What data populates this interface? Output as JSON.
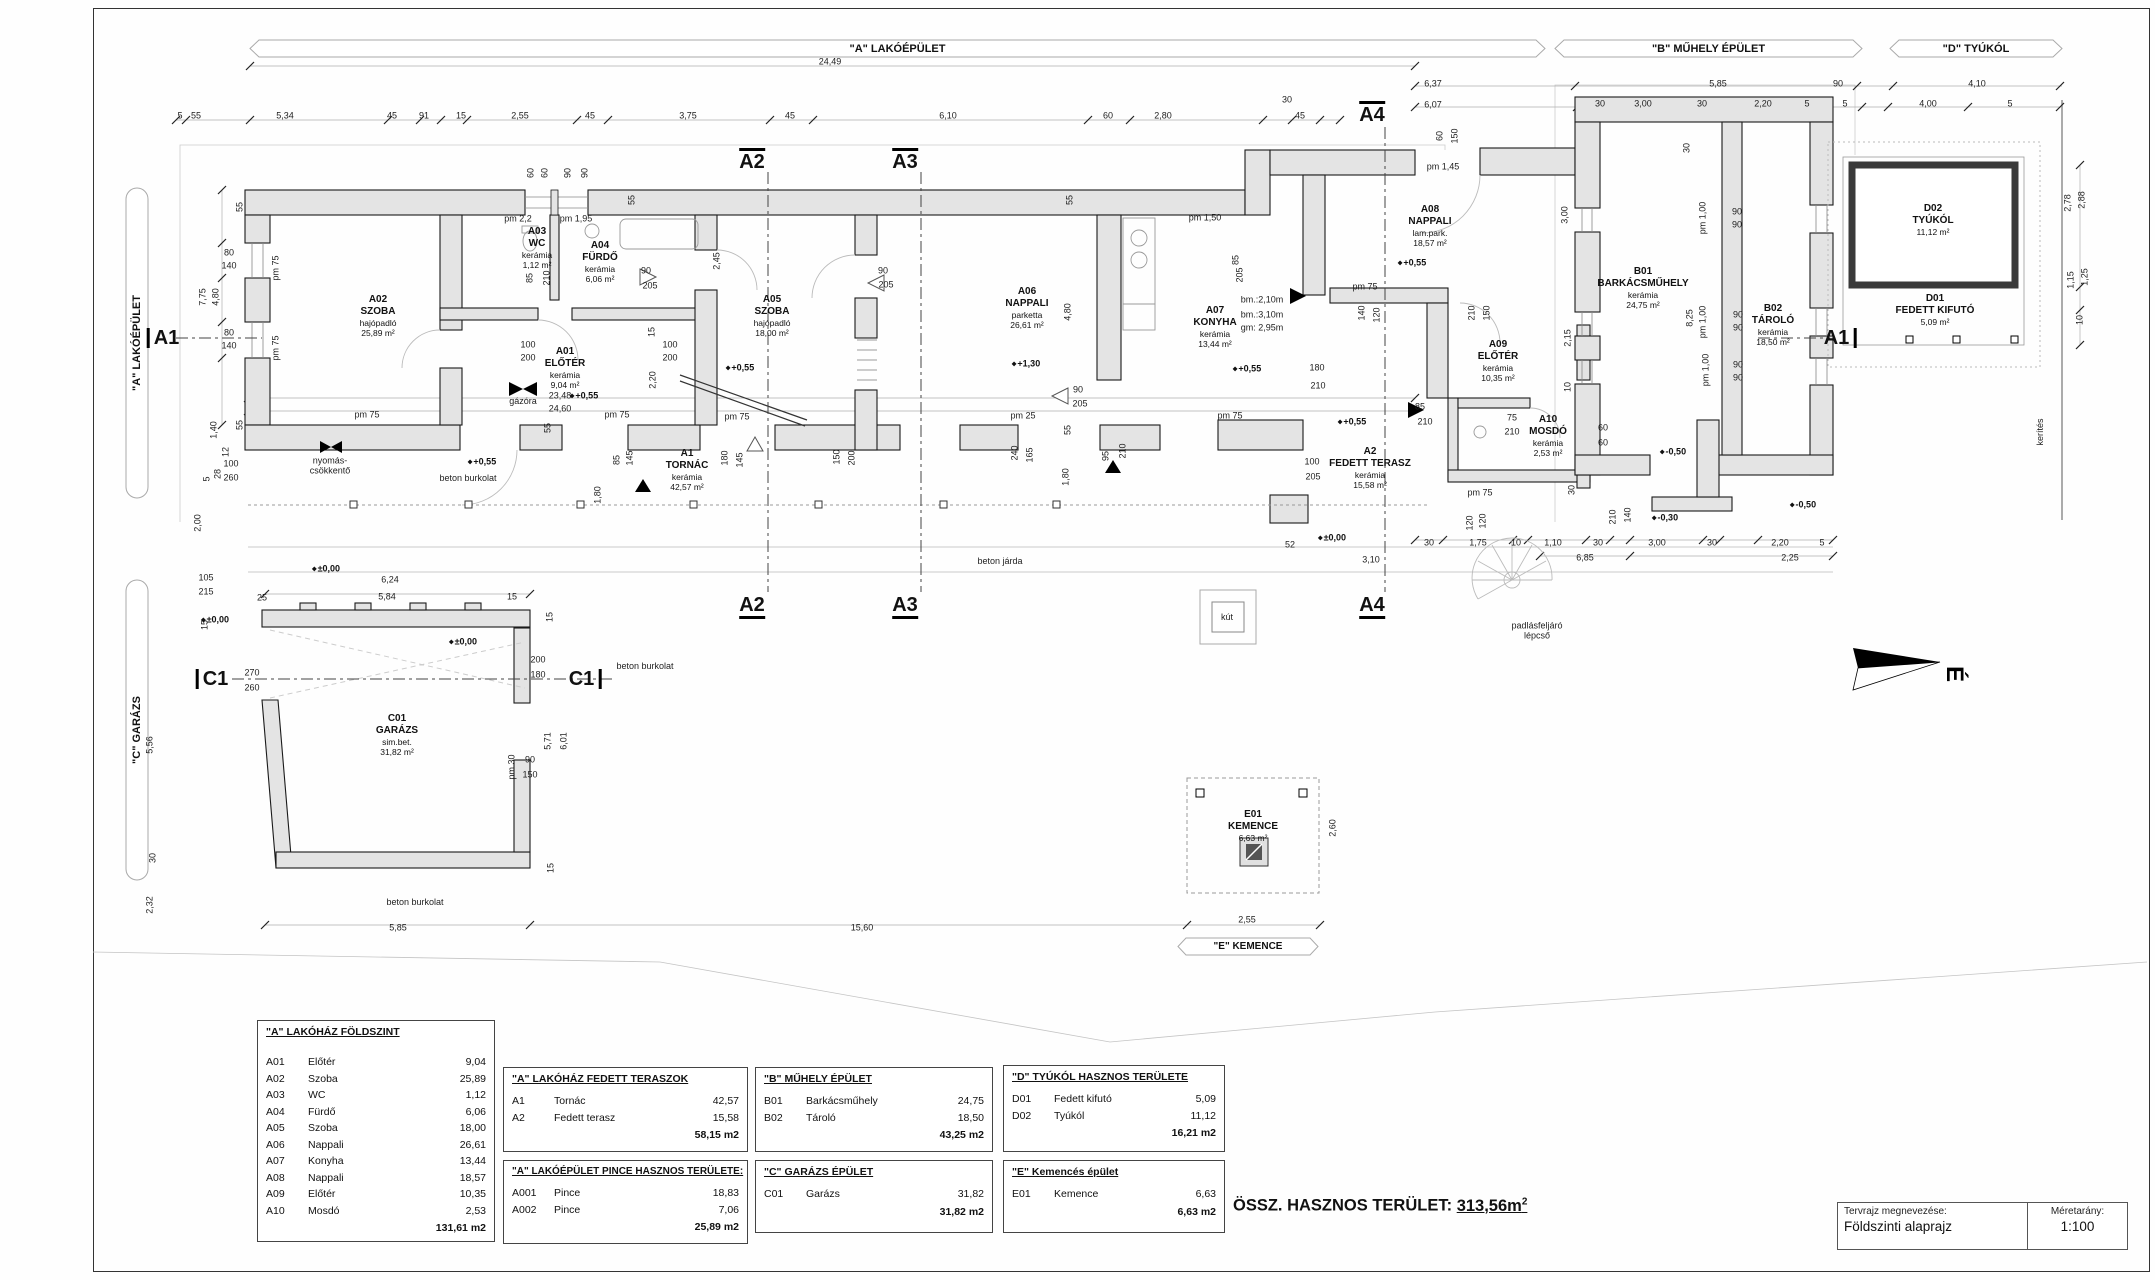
{
  "sheet": {
    "drawing_name_label": "Tervrajz megnevezése:",
    "drawing_name": "Földszinti alaprajz",
    "scale_label": "Méretarány:",
    "scale": "1:100"
  },
  "summary": {
    "label": "ÖSSZ. HASZNOS TERÜLET:",
    "value": "313,56m",
    "sup": "2"
  },
  "north": {
    "label": "É"
  },
  "banners": {
    "top": [
      {
        "text": "\"A\" LAKÓÉPÜLET",
        "x1": 250,
        "x2": 1545
      },
      {
        "text": "\"B\" MŰHELY ÉPÜLET",
        "x1": 1555,
        "x2": 1862
      },
      {
        "text": "\"D\" TYÚKÓL",
        "x1": 1890,
        "x2": 2062
      }
    ],
    "left": [
      {
        "text": "\"A\" LAKÓÉPÜLET",
        "y1": 188,
        "y2": 498
      },
      {
        "text": "\"C\" GARÁZS",
        "y1": 580,
        "y2": 880
      }
    ],
    "bottom": [
      {
        "text": "\"E\" KEMENCE",
        "x1": 1178,
        "x2": 1318,
        "y": 938
      }
    ]
  },
  "markers": [
    {
      "t": "A1",
      "x": 163,
      "y": 338,
      "k": "barL"
    },
    {
      "t": "A1",
      "x": 1840,
      "y": 338,
      "k": "barR"
    },
    {
      "t": "A2",
      "x": 752,
      "y": 160,
      "k": "top"
    },
    {
      "t": "A3",
      "x": 905,
      "y": 160,
      "k": "top"
    },
    {
      "t": "A4",
      "x": 1372,
      "y": 113,
      "k": "top"
    },
    {
      "t": "A2",
      "x": 752,
      "y": 607,
      "k": "bottom"
    },
    {
      "t": "A3",
      "x": 905,
      "y": 607,
      "k": "bottom"
    },
    {
      "t": "A4",
      "x": 1372,
      "y": 607,
      "k": "bottom"
    },
    {
      "t": "C1",
      "x": 212,
      "y": 679,
      "k": "barL"
    },
    {
      "t": "C1",
      "x": 585,
      "y": 679,
      "k": "barR"
    }
  ],
  "rooms": [
    {
      "code": "A01",
      "name": "ELŐTÉR",
      "floor": "kerámia",
      "area": "9,04 m²",
      "x": 565,
      "y": 368
    },
    {
      "code": "A02",
      "name": "SZOBA",
      "floor": "hajópadló",
      "area": "25,89 m²",
      "x": 378,
      "y": 316
    },
    {
      "code": "A03",
      "name": "WC",
      "floor": "kerámia",
      "area": "1,12 m²",
      "x": 537,
      "y": 248
    },
    {
      "code": "A04",
      "name": "FÜRDŐ",
      "floor": "kerámia",
      "area": "6,06 m²",
      "x": 600,
      "y": 262
    },
    {
      "code": "A05",
      "name": "SZOBA",
      "floor": "hajópadló",
      "area": "18,00 m²",
      "x": 772,
      "y": 316
    },
    {
      "code": "A06",
      "name": "NAPPALI",
      "floor": "parketta",
      "area": "26,61 m²",
      "x": 1027,
      "y": 308
    },
    {
      "code": "A07",
      "name": "KONYHA",
      "floor": "kerámia",
      "area": "13,44 m²",
      "x": 1215,
      "y": 327
    },
    {
      "code": "A08",
      "name": "NAPPALI",
      "floor": "lam.park.",
      "area": "18,57 m²",
      "x": 1430,
      "y": 226
    },
    {
      "code": "A09",
      "name": "ELŐTÉR",
      "floor": "kerámia",
      "area": "10,35 m²",
      "x": 1498,
      "y": 361
    },
    {
      "code": "A10",
      "name": "MOSDÓ",
      "floor": "kerámia",
      "area": "2,53 m²",
      "x": 1548,
      "y": 436
    },
    {
      "code": "A1",
      "name": "TORNÁC",
      "floor": "kerámia",
      "area": "42,57 m²",
      "x": 687,
      "y": 470
    },
    {
      "code": "A2",
      "name": "FEDETT TERASZ",
      "floor": "kerámia",
      "area": "15,58 m²",
      "x": 1370,
      "y": 468
    },
    {
      "code": "B01",
      "name": "BARKÁCSMŰHELY",
      "floor": "kerámia",
      "area": "24,75 m²",
      "x": 1643,
      "y": 288
    },
    {
      "code": "B02",
      "name": "TÁROLÓ",
      "floor": "kerámia",
      "area": "18,50 m²",
      "x": 1773,
      "y": 325
    },
    {
      "code": "C01",
      "name": "GARÁZS",
      "floor": "sim.bet.",
      "area": "31,82 m²",
      "x": 397,
      "y": 735
    },
    {
      "code": "D01",
      "name": "FEDETT KIFUTÓ",
      "floor": "",
      "area": "5,09 m²",
      "x": 1935,
      "y": 310
    },
    {
      "code": "D02",
      "name": "TYÚKÓL",
      "floor": "",
      "area": "11,12 m²",
      "x": 1933,
      "y": 220
    },
    {
      "code": "E01",
      "name": "KEMENCE",
      "floor": "",
      "area": "6,63 m²",
      "x": 1253,
      "y": 826
    }
  ],
  "dims": [
    [
      "24,49",
      830,
      62
    ],
    [
      "6,37",
      1433,
      84
    ],
    [
      "6,07",
      1433,
      105
    ],
    [
      "5,85",
      1718,
      84
    ],
    [
      "90",
      1838,
      84
    ],
    [
      "4,10",
      1977,
      84
    ],
    [
      "30",
      1600,
      104
    ],
    [
      "3,00",
      1643,
      104
    ],
    [
      "30",
      1702,
      104
    ],
    [
      "2,20",
      1763,
      104
    ],
    [
      "5",
      1807,
      104
    ],
    [
      "5",
      1845,
      104
    ],
    [
      "4,00",
      1928,
      104
    ],
    [
      "5",
      2010,
      104
    ],
    [
      "5",
      180,
      116
    ],
    [
      "55",
      196,
      116
    ],
    [
      "5,34",
      285,
      116
    ],
    [
      "45",
      392,
      116
    ],
    [
      "91",
      424,
      116
    ],
    [
      "15",
      461,
      116
    ],
    [
      "2,55",
      520,
      116
    ],
    [
      "45",
      590,
      116
    ],
    [
      "3,75",
      688,
      116
    ],
    [
      "45",
      790,
      116
    ],
    [
      "6,10",
      948,
      116
    ],
    [
      "60",
      1108,
      116
    ],
    [
      "2,80",
      1163,
      116
    ],
    [
      "30",
      1287,
      100
    ],
    [
      "45",
      1300,
      116
    ],
    [
      "60",
      1440,
      136,
      1
    ],
    [
      "150",
      1455,
      136,
      1
    ],
    [
      "55",
      240,
      207,
      1
    ],
    [
      "80",
      229,
      253
    ],
    [
      "140",
      229,
      266
    ],
    [
      "pm 75",
      276,
      268,
      1
    ],
    [
      "7,75",
      203,
      297,
      1
    ],
    [
      "4,80",
      216,
      297,
      1
    ],
    [
      "80",
      229,
      333
    ],
    [
      "140",
      229,
      346
    ],
    [
      "pm 75",
      276,
      348,
      1
    ],
    [
      "55",
      240,
      425,
      1
    ],
    [
      "1,40",
      214,
      430,
      1
    ],
    [
      "12",
      226,
      452,
      1
    ],
    [
      "28",
      218,
      474,
      1
    ],
    [
      "5",
      207,
      479,
      1
    ],
    [
      "100",
      231,
      464
    ],
    [
      "260",
      231,
      478
    ],
    [
      "2,00",
      198,
      523,
      1
    ],
    [
      "105",
      206,
      578
    ],
    [
      "215",
      206,
      592
    ],
    [
      "25",
      262,
      598
    ],
    [
      "15",
      205,
      625,
      1
    ],
    [
      "5,56",
      150,
      745,
      1
    ],
    [
      "30",
      153,
      858,
      1
    ],
    [
      "2,32",
      150,
      905,
      1
    ],
    [
      "pm 2,2",
      518,
      219
    ],
    [
      "pm 1,95",
      576,
      219
    ],
    [
      "60",
      531,
      173,
      1
    ],
    [
      "60",
      545,
      173,
      1
    ],
    [
      "90",
      568,
      173,
      1
    ],
    [
      "90",
      585,
      173,
      1
    ],
    [
      "85",
      530,
      278,
      1
    ],
    [
      "210",
      547,
      278,
      1
    ],
    [
      "2,45",
      717,
      261,
      1
    ],
    [
      "15",
      652,
      332,
      1
    ],
    [
      "2,20",
      653,
      380,
      1
    ],
    [
      "90",
      646,
      271
    ],
    [
      "205",
      650,
      286
    ],
    [
      "100",
      528,
      345
    ],
    [
      "200",
      528,
      358
    ],
    [
      "100",
      670,
      345
    ],
    [
      "200",
      670,
      358
    ],
    [
      "90",
      883,
      271
    ],
    [
      "205",
      886,
      285
    ],
    [
      "55",
      632,
      200,
      1
    ],
    [
      "55",
      1070,
      200,
      1
    ],
    [
      "55",
      1068,
      430,
      1
    ],
    [
      "55",
      548,
      428,
      1
    ],
    [
      "pm 75",
      367,
      415
    ],
    [
      "pm 75",
      617,
      415
    ],
    [
      "pm 75",
      737,
      417
    ],
    [
      "pm 25",
      1023,
      416
    ],
    [
      "pm 75",
      1230,
      416
    ],
    [
      "pm 1,50",
      1205,
      218
    ],
    [
      "4,80",
      1068,
      312,
      1
    ],
    [
      "90",
      1078,
      390
    ],
    [
      "205",
      1080,
      404
    ],
    [
      "240",
      1015,
      453,
      1
    ],
    [
      "165",
      1030,
      455,
      1
    ],
    [
      "95",
      1106,
      456,
      1
    ],
    [
      "210",
      1123,
      451,
      1
    ],
    [
      "1,80",
      598,
      495,
      1
    ],
    [
      "1,80",
      1066,
      477,
      1
    ],
    [
      "180",
      725,
      458,
      1
    ],
    [
      "145",
      740,
      460,
      1
    ],
    [
      "150",
      837,
      457,
      1
    ],
    [
      "200",
      852,
      458,
      1
    ],
    [
      "85",
      617,
      460,
      1
    ],
    [
      "145",
      630,
      458,
      1
    ],
    [
      "pm 1,45",
      1443,
      167
    ],
    [
      "85",
      1236,
      260,
      1
    ],
    [
      "205",
      1240,
      275,
      1
    ],
    [
      "pm 75",
      1365,
      287
    ],
    [
      "140",
      1362,
      313,
      1
    ],
    [
      "120",
      1377,
      315,
      1
    ],
    [
      "180",
      1317,
      368
    ],
    [
      "210",
      1318,
      386
    ],
    [
      "150",
      1487,
      313,
      1
    ],
    [
      "210",
      1472,
      313,
      1
    ],
    [
      "85",
      1420,
      407
    ],
    [
      "210",
      1425,
      422
    ],
    [
      "100",
      1312,
      462
    ],
    [
      "205",
      1313,
      477
    ],
    [
      "60",
      1603,
      428
    ],
    [
      "60",
      1603,
      443
    ],
    [
      "75",
      1512,
      418
    ],
    [
      "210",
      1512,
      432
    ],
    [
      "pm 75",
      1480,
      493
    ],
    [
      "3,00",
      1565,
      215,
      1
    ],
    [
      "2,15",
      1568,
      338,
      1
    ],
    [
      "10",
      1568,
      387,
      1
    ],
    [
      "30",
      1572,
      490,
      1
    ],
    [
      "30",
      1687,
      148,
      1
    ],
    [
      "pm 1,00",
      1703,
      218,
      1
    ],
    [
      "90",
      1737,
      212
    ],
    [
      "90",
      1737,
      225
    ],
    [
      "pm 1,00",
      1703,
      322,
      1
    ],
    [
      "90",
      1738,
      315
    ],
    [
      "90",
      1738,
      328
    ],
    [
      "pm 1,00",
      1706,
      370,
      1
    ],
    [
      "90",
      1738,
      365
    ],
    [
      "90",
      1738,
      378
    ],
    [
      "8,25",
      1690,
      318,
      1
    ],
    [
      "2,88",
      2082,
      200,
      1
    ],
    [
      "2,78",
      2068,
      203,
      1
    ],
    [
      "1,25",
      2085,
      277,
      1
    ],
    [
      "1,15",
      2071,
      280,
      1
    ],
    [
      "10",
      2080,
      320,
      1
    ],
    [
      "30",
      1429,
      543
    ],
    [
      "1,75",
      1478,
      543
    ],
    [
      "10",
      1516,
      543
    ],
    [
      "1,10",
      1553,
      543
    ],
    [
      "30",
      1598,
      543
    ],
    [
      "6,85",
      1585,
      558
    ],
    [
      "3,00",
      1657,
      543
    ],
    [
      "30",
      1712,
      543
    ],
    [
      "2,20",
      1780,
      543
    ],
    [
      "5",
      1822,
      543
    ],
    [
      "2,25",
      1790,
      558
    ],
    [
      "120",
      1470,
      523,
      1
    ],
    [
      "120",
      1483,
      521,
      1
    ],
    [
      "140",
      1628,
      515,
      1
    ],
    [
      "210",
      1613,
      517,
      1
    ],
    [
      "52",
      1290,
      545
    ],
    [
      "3,10",
      1371,
      560
    ],
    [
      "23,48",
      560,
      396
    ],
    [
      "24,60",
      560,
      409
    ],
    [
      "6,24",
      390,
      580
    ],
    [
      "5,84",
      387,
      597
    ],
    [
      "15",
      512,
      597
    ],
    [
      "270",
      252,
      673
    ],
    [
      "260",
      252,
      688
    ],
    [
      "200",
      538,
      660
    ],
    [
      "180",
      538,
      675
    ],
    [
      "90",
      530,
      760
    ],
    [
      "150",
      530,
      775
    ],
    [
      "pm 30",
      512,
      767,
      1
    ],
    [
      "5,71",
      548,
      741,
      1
    ],
    [
      "6,01",
      564,
      741,
      1
    ],
    [
      "15",
      550,
      617,
      1
    ],
    [
      "15",
      551,
      868,
      1
    ],
    [
      "5,85",
      398,
      928
    ],
    [
      "15,60",
      862,
      928
    ],
    [
      "2,55",
      1247,
      920
    ],
    [
      "2,60",
      1333,
      828,
      1
    ],
    [
      "bm.:2,10m",
      1262,
      300
    ],
    [
      "bm.:3,10m",
      1262,
      315
    ],
    [
      "gm: 2,95m",
      1262,
      328
    ]
  ],
  "levels": [
    [
      "+0,55",
      584,
      396
    ],
    [
      "+0,55",
      740,
      368
    ],
    [
      "+1,30",
      1026,
      364
    ],
    [
      "+0,55",
      1247,
      369
    ],
    [
      "+0,55",
      1412,
      263
    ],
    [
      "+0,55",
      1352,
      422
    ],
    [
      "+0,55",
      482,
      462
    ],
    [
      "±0,00",
      326,
      569
    ],
    [
      "±0,00",
      215,
      620
    ],
    [
      "±0,00",
      463,
      642
    ],
    [
      "±0,00",
      1332,
      538
    ],
    [
      "-0,50",
      1673,
      452
    ],
    [
      "-0,30",
      1665,
      518
    ],
    [
      "-0,50",
      1803,
      505
    ]
  ],
  "notes": [
    [
      "nyomás-\ncsökkentő",
      330,
      466
    ],
    [
      "gázóra",
      523,
      401
    ],
    [
      "beton járda",
      1000,
      561
    ],
    [
      "beton burkolat",
      468,
      478
    ],
    [
      "beton burkolat",
      645,
      666
    ],
    [
      "beton burkolat",
      415,
      902
    ],
    [
      "kút",
      1227,
      617
    ],
    [
      "padlásfeljáró\nlépcső",
      1537,
      631
    ],
    [
      "kerítés",
      2040,
      432,
      1
    ]
  ],
  "tables": [
    {
      "title": "\"A\"  LAKÓHÁZ FÖLDSZINT",
      "x": 257,
      "y": 1020,
      "w": 238,
      "h": 222,
      "gap": 16,
      "rows": [
        [
          "A01",
          "Előtér",
          "9,04"
        ],
        [
          "A02",
          "Szoba",
          "25,89"
        ],
        [
          "A03",
          "WC",
          "1,12"
        ],
        [
          "A04",
          "Fürdő",
          "6,06"
        ],
        [
          "A05",
          "Szoba",
          "18,00"
        ],
        [
          "A06",
          "Nappali",
          "26,61"
        ],
        [
          "A07",
          "Konyha",
          "13,44"
        ],
        [
          "A08",
          "Nappali",
          "18,57"
        ],
        [
          "A09",
          "Előtér",
          "10,35"
        ],
        [
          "A10",
          "Mosdó",
          "2,53"
        ]
      ],
      "total": "131,61 m2"
    },
    {
      "title": "\"A\" LAKÓHÁZ FEDETT TERASZOK",
      "x": 503,
      "y": 1067,
      "w": 245,
      "h": 85,
      "gap": 8,
      "rows": [
        [
          "A1",
          "Tornác",
          "42,57"
        ],
        [
          "A2",
          "Fedett terasz",
          "15,58"
        ]
      ],
      "total": "58,15 m2"
    },
    {
      "title": "\"A\" LAKÓÉPÜLET PINCE HASZNOS TERÜLETE:",
      "x": 503,
      "y": 1160,
      "w": 245,
      "h": 84,
      "gap": 8,
      "rows": [
        [
          "A001",
          "Pince",
          "18,83"
        ],
        [
          "A002",
          "Pince",
          "7,06"
        ]
      ],
      "total": "25,89 m2"
    },
    {
      "title": "\"B\"  MŰHELY ÉPÜLET",
      "x": 755,
      "y": 1067,
      "w": 238,
      "h": 85,
      "gap": 8,
      "rows": [
        [
          "B01",
          "Barkácsműhely",
          "24,75"
        ],
        [
          "B02",
          "Tároló",
          "18,50"
        ]
      ],
      "total": "43,25 m2"
    },
    {
      "title": "\"C\"  GARÁZS ÉPÜLET",
      "x": 755,
      "y": 1160,
      "w": 238,
      "h": 73,
      "gap": 8,
      "rows": [
        [
          "C01",
          "Garázs",
          "31,82"
        ]
      ],
      "total": "31,82 m2"
    },
    {
      "title": "\"D\" TYÚKÓL HASZNOS TERÜLETE",
      "x": 1003,
      "y": 1065,
      "w": 222,
      "h": 87,
      "gap": 8,
      "rows": [
        [
          "D01",
          "Fedett kifutó",
          "5,09"
        ],
        [
          "D02",
          "Tyúkól",
          "11,12"
        ]
      ],
      "total": "16,21 m2"
    },
    {
      "title": "\"E\" Kemencés épület",
      "x": 1003,
      "y": 1160,
      "w": 222,
      "h": 73,
      "gap": 8,
      "rows": [
        [
          "E01",
          "Kemence",
          "6,63"
        ]
      ],
      "total": "6,63 m2"
    }
  ]
}
